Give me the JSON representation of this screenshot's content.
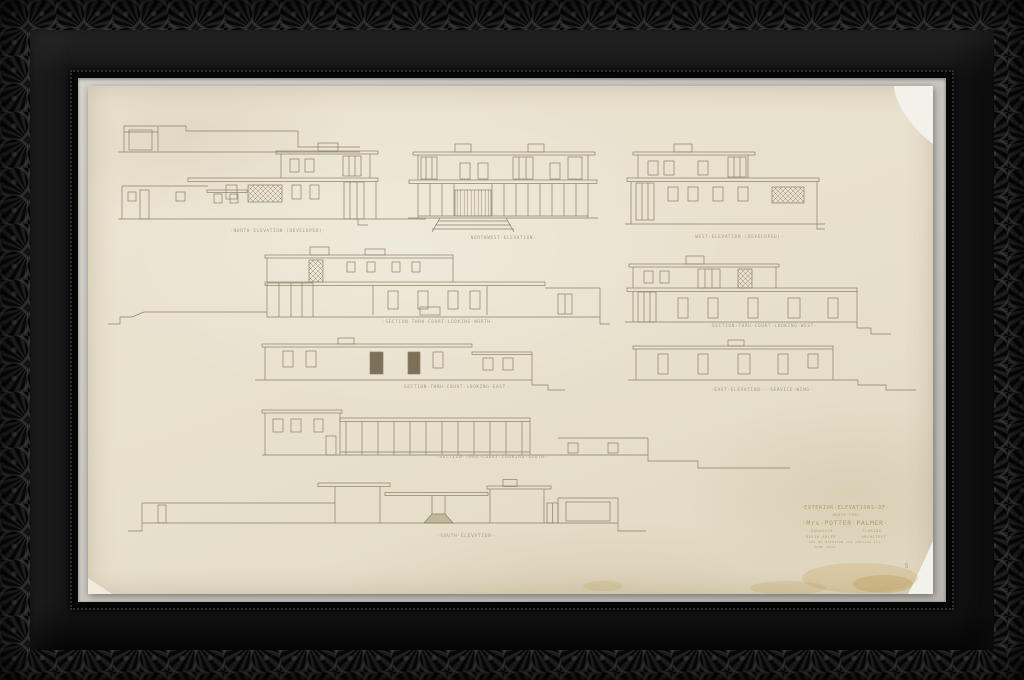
{
  "artwork": {
    "description": "Framed architectural drawing, exterior elevations of a house",
    "labels": {
      "north": "·NORTH·ELEVATION·(DEVELOPED)·",
      "northwest": "·NORTHWEST·ELEVATION·",
      "west": "·WEST·ELEVATION·(DEVELOPED)·",
      "section_north": "·SECTION·THRU·COURT·LOOKING·NORTH·",
      "section_west": "·SECTION·THRU·COURT·LOOKING·WEST·",
      "section_east": "·SECTION·THRU·COURT·LOOKING·EAST·",
      "east_service": "·EAST·ELEVATION···SERVICE·WING·",
      "section_south": "·SECTION·THRU·COURT·LOOKING·SOUTH·",
      "south": "·SOUTH·ELEVATION·"
    },
    "title_block": {
      "line1": "·EXTERIOR·ELEVATIONS·OF·",
      "line2": "·HOUSE·FOR·",
      "client": "·Mrs·POTTER·PALMER·",
      "location_left": "SARASOTA",
      "location_right": "FLORIDA",
      "architect_left": "DAVID ADLER",
      "architect_right": "ARCHITECT",
      "address": "664 NO MICHIGAN AVE CHICAGO ILL",
      "date": "JUNE 1936",
      "sheet_number": "5"
    },
    "colors": {
      "frame": "#131313",
      "liner": "#cdcac3",
      "paper": "#e7e0cc",
      "ink": "#8d8068",
      "label_ink": "#ab9a7e",
      "stain": "#ba9442"
    }
  }
}
